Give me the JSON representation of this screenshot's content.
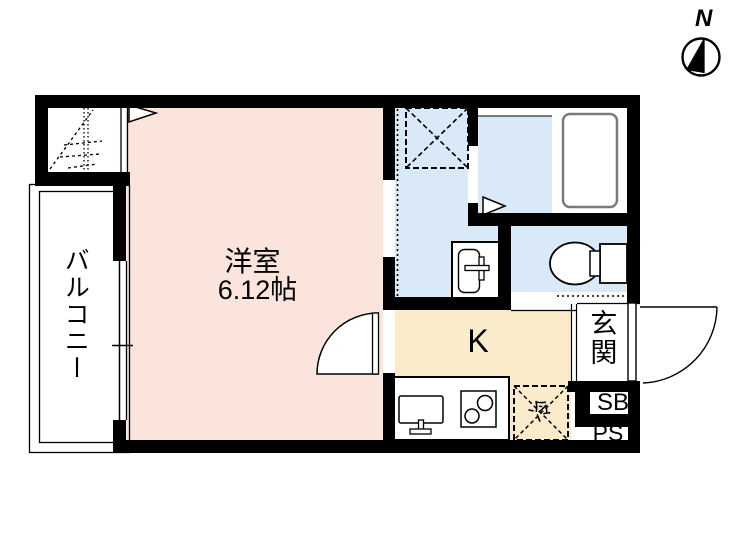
{
  "labels": {
    "north": "N",
    "balcony": "バルコニー",
    "main_room": "洋室",
    "main_room_size": "6.12帖",
    "kitchen": "K",
    "entrance": "玄関",
    "shoe_box": "SB",
    "pipe_space": "PS",
    "refrigerator": "冷"
  },
  "colors": {
    "main_room_pink": "#fbe4dc",
    "wet_area_blue": "#d9e9f8",
    "kitchen_cream": "#faeccb",
    "wall_black": "#000000",
    "tub_gray": "#7a7a7a"
  }
}
